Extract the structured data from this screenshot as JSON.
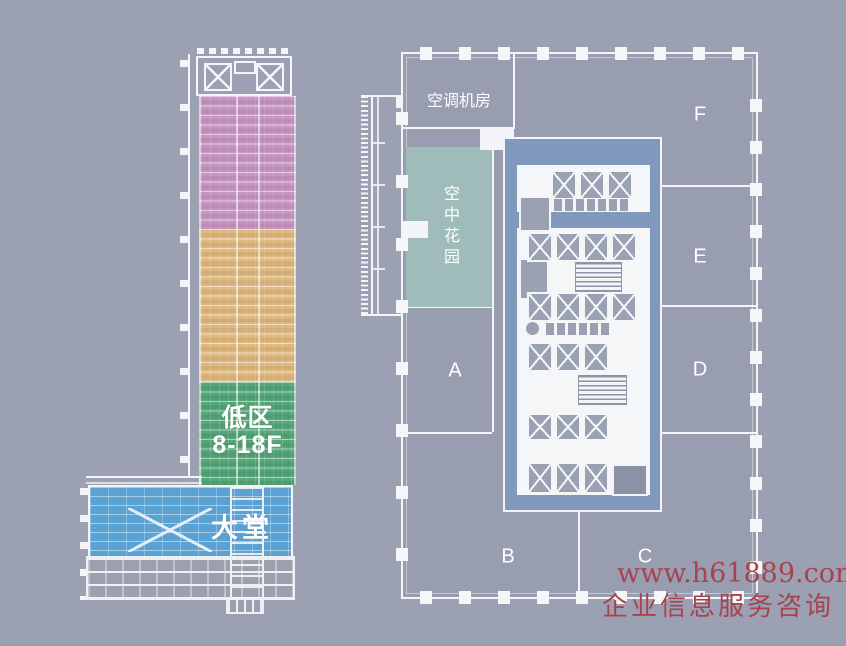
{
  "elevation": {
    "low_zone": {
      "line1": "低区",
      "line2": "8-18F"
    },
    "lobby_label": "大堂",
    "zone_colors": {
      "high_zone": "#c795c2",
      "mid_zone": "#dfb87e",
      "low_zone": "#55a678",
      "lobby": "#5ba2d4"
    }
  },
  "floor_plan": {
    "ac_room_label": "空调机房",
    "sky_garden_label": "空中花园",
    "sky_garden_color": "#9fbcba",
    "core_color": "#8199bd",
    "zone_labels": [
      {
        "label": "A"
      },
      {
        "label": "B"
      },
      {
        "label": "C"
      },
      {
        "label": "D"
      },
      {
        "label": "E"
      },
      {
        "label": "F"
      }
    ]
  },
  "watermark": {
    "line1": "www.h61889.com",
    "line2": "企业信息服务咨询",
    "color": "#a8434d"
  }
}
